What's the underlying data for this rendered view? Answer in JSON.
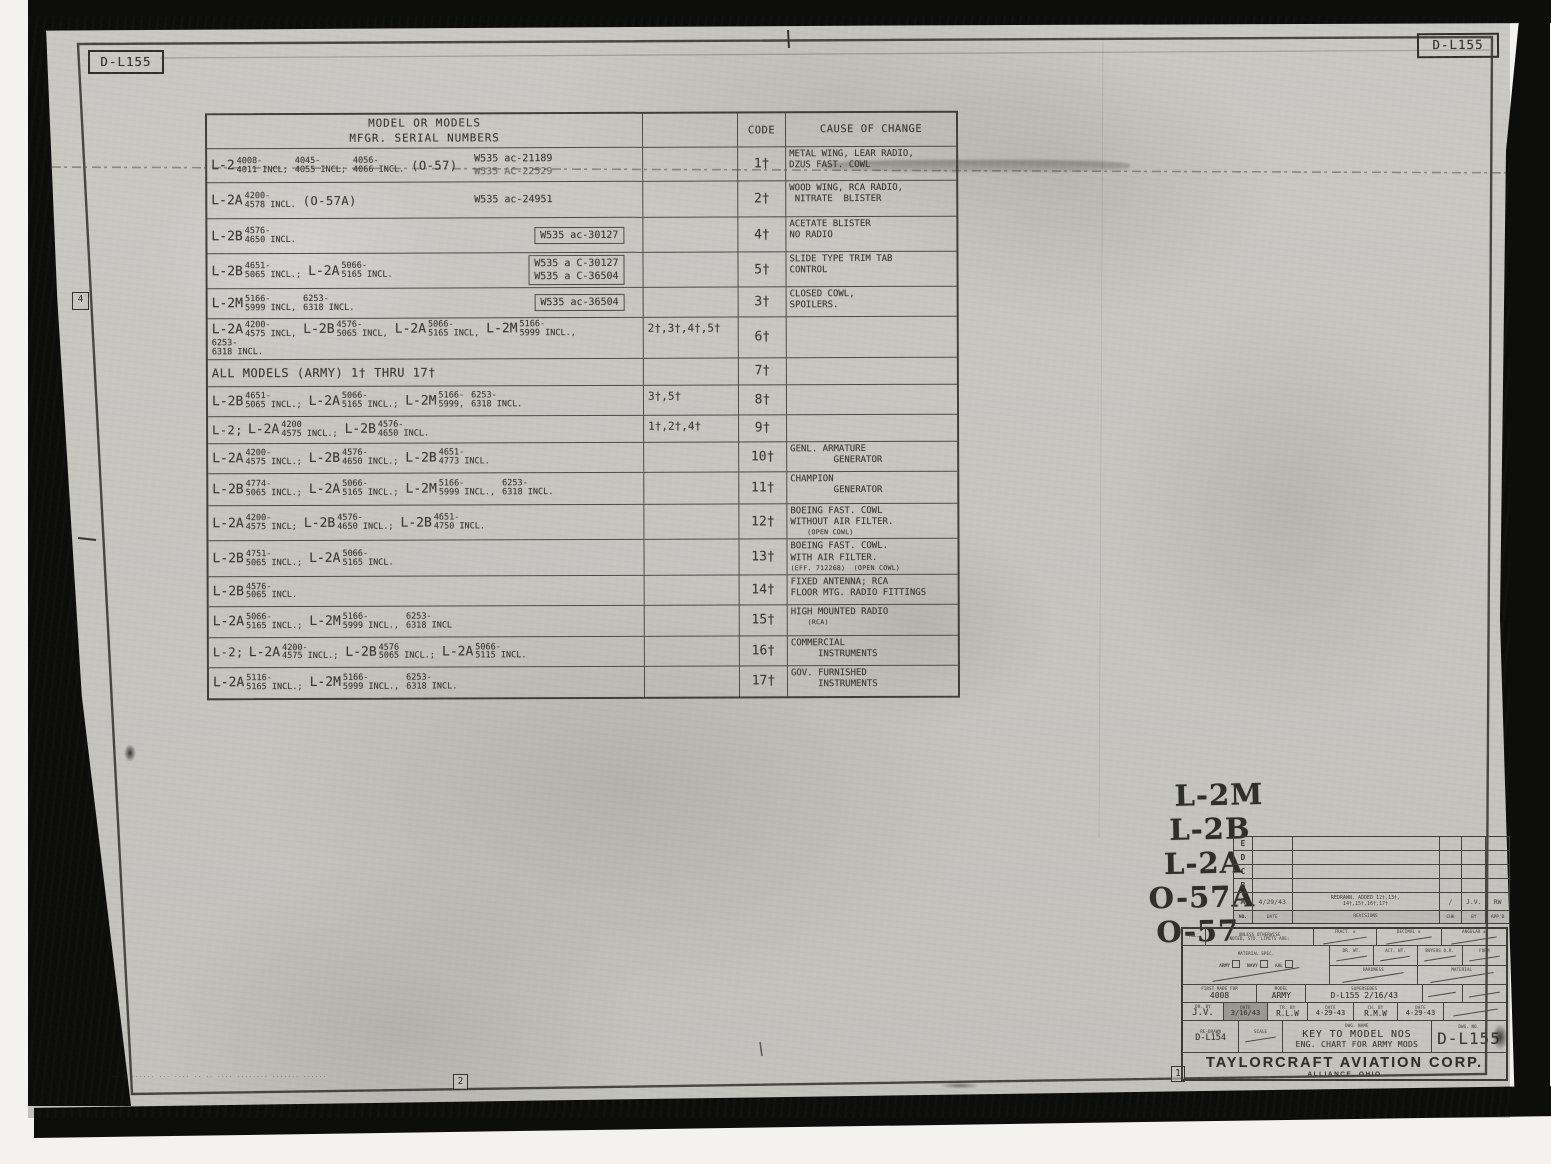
{
  "colors": {
    "paper": "#c7c6c1",
    "ink": "#3b3b33",
    "scan_black": "#0d0d0c"
  },
  "document": {
    "corner_labels": {
      "top_left": "D-L155",
      "top_right": "D-L155"
    },
    "edge_markers": {
      "left": "4",
      "bottom_center": "2",
      "bottom_right": "1"
    },
    "fine_print": "·· · ······ ··· ···· ··   ·· ···· ········ ······· ······"
  },
  "table": {
    "header": {
      "models_line1": "MODEL OR MODELS",
      "models_line2": "MFGR. SERIAL NUMBERS",
      "code": "CODE",
      "cause": "CAUSE OF CHANGE"
    },
    "rows": [
      {
        "models": [
          {
            "m": "L-2",
            "t": "4008-",
            "b": "4011 INCL;"
          },
          {
            "t": "4045-",
            "b": "4055 INCL;"
          },
          {
            "t": "4056-",
            "b": "4066 INCL."
          },
          {
            "p": "(O-57)"
          }
        ],
        "contracts": [
          "W535 ac-21189",
          "W535 AC-22529"
        ],
        "code": "1†",
        "cause": [
          "METAL WING, LEAR RADIO,",
          "DZUS FAST. COWL"
        ]
      },
      {
        "models": [
          {
            "m": "L-2A",
            "t": "4200-",
            "b": "4578 INCL."
          },
          {
            "p": "(O-57A)"
          }
        ],
        "contracts": [
          "W535 ac-24951"
        ],
        "code": "2†",
        "cause": [
          "WOOD WING, RCA RADIO,",
          " NITRATE  BLISTER"
        ]
      },
      {
        "models": [
          {
            "m": "L-2B",
            "t": "4576-",
            "b": "4650 INCL."
          }
        ],
        "contracts": [
          "W535 ac-30127"
        ],
        "boxed": true,
        "code": "4†",
        "cause": [
          "ACETATE BLISTER",
          "NO RADIO"
        ]
      },
      {
        "models": [
          {
            "m": "L-2B",
            "t": "4651-",
            "b": "5065 INCL.;"
          },
          {
            "m": "L-2A",
            "t": "5066-",
            "b": "5165 INCL."
          }
        ],
        "contracts": [
          "W535 a C-30127",
          "W535 a C-36504"
        ],
        "boxed": true,
        "code": "5†",
        "cause": [
          "SLIDE TYPE TRIM TAB",
          "CONTROL"
        ]
      },
      {
        "models": [
          {
            "m": "L-2M",
            "t": "5166-",
            "b": "5999 INCL,"
          },
          {
            "t": "6253-",
            "b": "6318 INCL."
          }
        ],
        "contracts": [
          "W535 ac-36504"
        ],
        "boxed": true,
        "code": "3†",
        "cause": [
          "CLOSED COWL,",
          "SPOILERS."
        ]
      },
      {
        "models": [
          {
            "m": "L-2A",
            "t": "4200-",
            "b": "4575 INCL,"
          },
          {
            "m": "L-2B",
            "t": "4576-",
            "b": "5065 INCL,"
          },
          {
            "m": "L-2A",
            "t": "5066-",
            "b": "5165 INCL,"
          },
          {
            "m": "L-2M",
            "t": "5166-",
            "b": "5999 INCL.,"
          },
          {
            "t": "6253-",
            "b": "6318 INCL."
          }
        ],
        "extra": "2†,3†,4†,5†",
        "code": "6†",
        "cause": []
      },
      {
        "models": [
          {
            "p": "ALL MODELS (ARMY) 1† THRU 17†"
          }
        ],
        "code": "7†",
        "cause": []
      },
      {
        "models": [
          {
            "m": "L-2B",
            "t": "4651-",
            "b": "5065 INCL.;"
          },
          {
            "m": "L-2A",
            "t": "5066-",
            "b": "5165 INCL.;"
          },
          {
            "m": "L-2M",
            "t": "5166-",
            "b": "5999,"
          },
          {
            "t": "6253-",
            "b": "6318 INCL."
          }
        ],
        "extra": "3†,5†",
        "code": "8†",
        "cause": []
      },
      {
        "models": [
          {
            "p": "L-2;"
          },
          {
            "m": "L-2A",
            "t": "4200",
            "b": "4575 INCL.;"
          },
          {
            "m": "L-2B",
            "t": "4576-",
            "b": "4650 INCL."
          }
        ],
        "extra": "1†,2†,4†",
        "code": "9†",
        "cause": []
      },
      {
        "models": [
          {
            "m": "L-2A",
            "t": "4200-",
            "b": "4575 INCL.;"
          },
          {
            "m": "L-2B",
            "t": "4576-",
            "b": "4650 INCL.;"
          },
          {
            "m": "L-2B",
            "t": "4651-",
            "b": "4773 INCL."
          }
        ],
        "code": "10†",
        "cause": [
          "GENL. ARMATURE",
          "        GENERATOR"
        ]
      },
      {
        "models": [
          {
            "m": "L-2B",
            "t": "4774-",
            "b": "5065 INCL.;"
          },
          {
            "m": "L-2A",
            "t": "5066-",
            "b": "5165 INCL.;"
          },
          {
            "m": "L-2M",
            "t": "5166-",
            "b": "5999 INCL.,"
          },
          {
            "t": "6253-",
            "b": "6318 INCL."
          }
        ],
        "code": "11†",
        "cause": [
          "CHAMPION",
          "        GENERATOR"
        ]
      },
      {
        "models": [
          {
            "m": "L-2A",
            "t": "4200-",
            "b": "4575 INCL;"
          },
          {
            "m": "L-2B",
            "t": "4576-",
            "b": "4650 INCL.;"
          },
          {
            "m": "L-2B",
            "t": "4651-",
            "b": "4750 INCL."
          }
        ],
        "code": "12†",
        "cause": [
          "BOEING FAST. COWL",
          "WITHOUT AIR FILTER.",
          "    (OPEN COWL)"
        ]
      },
      {
        "models": [
          {
            "m": "L-2B",
            "t": "4751-",
            "b": "5065 INCL.;"
          },
          {
            "m": "L-2A",
            "t": "5066-",
            "b": "5165 INCL."
          }
        ],
        "code": "13†",
        "cause": [
          "BOEING FAST. COWL.",
          "WITH AIR FILTER.",
          "(EFF. 712268)  (OPEN COWL)"
        ]
      },
      {
        "models": [
          {
            "m": "L-2B",
            "t": "4576-",
            "b": "5065 INCL."
          }
        ],
        "code": "14†",
        "cause": [
          "FIXED ANTENNA; RCA",
          "FLOOR MTG. RADIO FITTINGS"
        ]
      },
      {
        "models": [
          {
            "m": "L-2A",
            "t": "5066-",
            "b": "5165 INCL.;"
          },
          {
            "m": "L-2M",
            "t": "5166-",
            "b": "5999 INCL.,"
          },
          {
            "t": "6253-",
            "b": "6318 INCL"
          }
        ],
        "code": "15†",
        "cause": [
          "HIGH MOUNTED RADIO",
          "    (RCA)"
        ]
      },
      {
        "models": [
          {
            "p": "L-2;"
          },
          {
            "m": "L-2A",
            "t": "4200-",
            "b": "4575 INCL.;"
          },
          {
            "m": "L-2B",
            "t": "4576",
            "b": "5065 INCL.;"
          },
          {
            "m": "L-2A",
            "t": "5066-",
            "b": "5115 INCL."
          }
        ],
        "code": "16†",
        "cause": [
          "COMMERCIAL",
          "     INSTRUMENTS"
        ]
      },
      {
        "models": [
          {
            "m": "L-2A",
            "t": "5116-",
            "b": "5165 INCL.;"
          },
          {
            "m": "L-2M",
            "t": "5166-",
            "b": "5999 INCL.,"
          },
          {
            "t": "6253-",
            "b": "6318 INCL."
          }
        ],
        "code": "17†",
        "cause": [
          "GOV. FURNISHED",
          "     INSTRUMENTS"
        ]
      }
    ]
  },
  "model_list": [
    "L-2M",
    "L-2B",
    "L-2A",
    "O-57A",
    "O-57"
  ],
  "revision_table": {
    "headers": {
      "sym": "NO.",
      "date": "DATE",
      "revisions": "REVISIONS",
      "chk": "CHK",
      "by": "BY",
      "appd": "APP'D"
    },
    "rows": [
      {
        "sym": "E",
        "date": "",
        "text1": "",
        "text2": "",
        "chk": "",
        "by": "",
        "appd": ""
      },
      {
        "sym": "D",
        "date": "",
        "text1": "",
        "text2": "",
        "chk": "",
        "by": "",
        "appd": ""
      },
      {
        "sym": "C",
        "date": "",
        "text1": "",
        "text2": "",
        "chk": "",
        "by": "",
        "appd": ""
      },
      {
        "sym": "B",
        "date": "",
        "text1": "",
        "text2": "",
        "chk": "",
        "by": "",
        "appd": ""
      },
      {
        "sym": "A",
        "date": "4/29/43",
        "text1": "REDRAWN. ADDED 12†,13†,",
        "text2": "14†,15†,16†,17†",
        "chk": "/",
        "by": "J.V.",
        "appd": "RW"
      }
    ]
  },
  "title_block": {
    "tol_label": "TOL.",
    "tol_note_1": "UNLESS OTHERWISE",
    "tol_note_2": "NOTED, STD. LIMITS ARE:",
    "fract": "FRACT. ±",
    "decimal": "DECIMAL ±",
    "angular": "ANGULAR ±",
    "material_spec": "MATERIAL SPEC.",
    "spec_army": "ARMY",
    "spec_navy": "NAVY",
    "spec_aal": "AAL",
    "dr_wt": "DR. WT.",
    "act_wt": "ACT. WT.",
    "buyers_ok": "BUYERS O.K.",
    "form": "FORM",
    "hardness": "HARDNESS",
    "material": "MATERIAL",
    "first_made_label": "FIRST MADE FOR",
    "first_made": "4008",
    "model_label": "MODEL",
    "model": "ARMY",
    "supersedes_label": "SUPERSEDES",
    "supersedes": "D-L155  2/16/43",
    "dr_by_label": "DR. BY",
    "dr_by": "J.V.",
    "dr_date": "3/16/43",
    "tr_by_label": "TR. BY",
    "tr_by": "R.L.W",
    "tr_date": "4-29-43",
    "ch_by_label": "CH. BY",
    "ch_by": "R.M.W",
    "ch_date": "4-29-43",
    "date_label": "DATE",
    "ref_label": "RE-DRAWN",
    "ref_dwg": "D-L154",
    "scale_label": "SCALE",
    "dwg_name_label": "DWG. NAME",
    "title_1": "KEY TO MODEL NOS",
    "title_2": "ENG. CHART FOR ARMY MODS",
    "dwg_no_label": "DWG. NO.",
    "dwg_no": "D-L155"
  },
  "company": {
    "name": "TAYLORCRAFT AVIATION CORP.",
    "location": "ALLIANCE, OHIO"
  }
}
